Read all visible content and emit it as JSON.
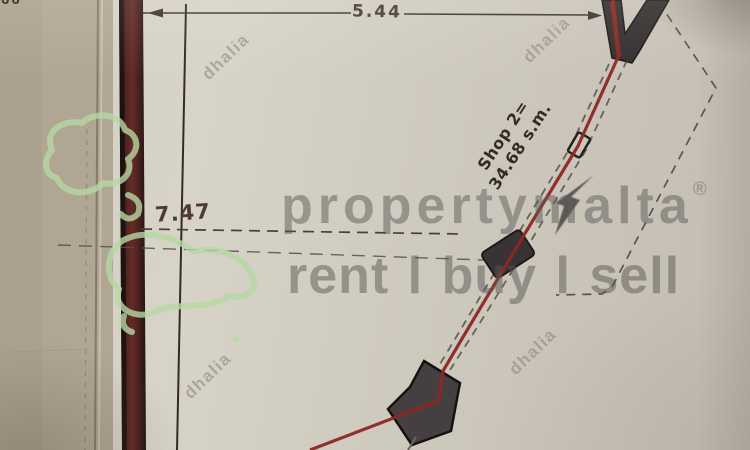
{
  "plan": {
    "dimensions": {
      "top": "5.44",
      "side": "7.47"
    },
    "labels": {
      "shop_line1": "Shop 2=",
      "shop_line2": "34.68 s.m."
    },
    "stray_marks": "66"
  },
  "watermarks": {
    "brand": "propertymalta",
    "registered_symbol": "®",
    "tagline": "rent l buy l sell",
    "agency": "dhalia",
    "logo_icon": "malta-islands-outline"
  },
  "colors": {
    "paper": "#d2cdc1",
    "paper_margin": "#b2a794",
    "wall_red": "#5e2422",
    "boundary_red": "#8c2723",
    "ink": "#3b342c",
    "structure_fill": "#3a3335",
    "watermark_gray": "#5c5c5a",
    "logo_green": "#b7d8a4"
  }
}
